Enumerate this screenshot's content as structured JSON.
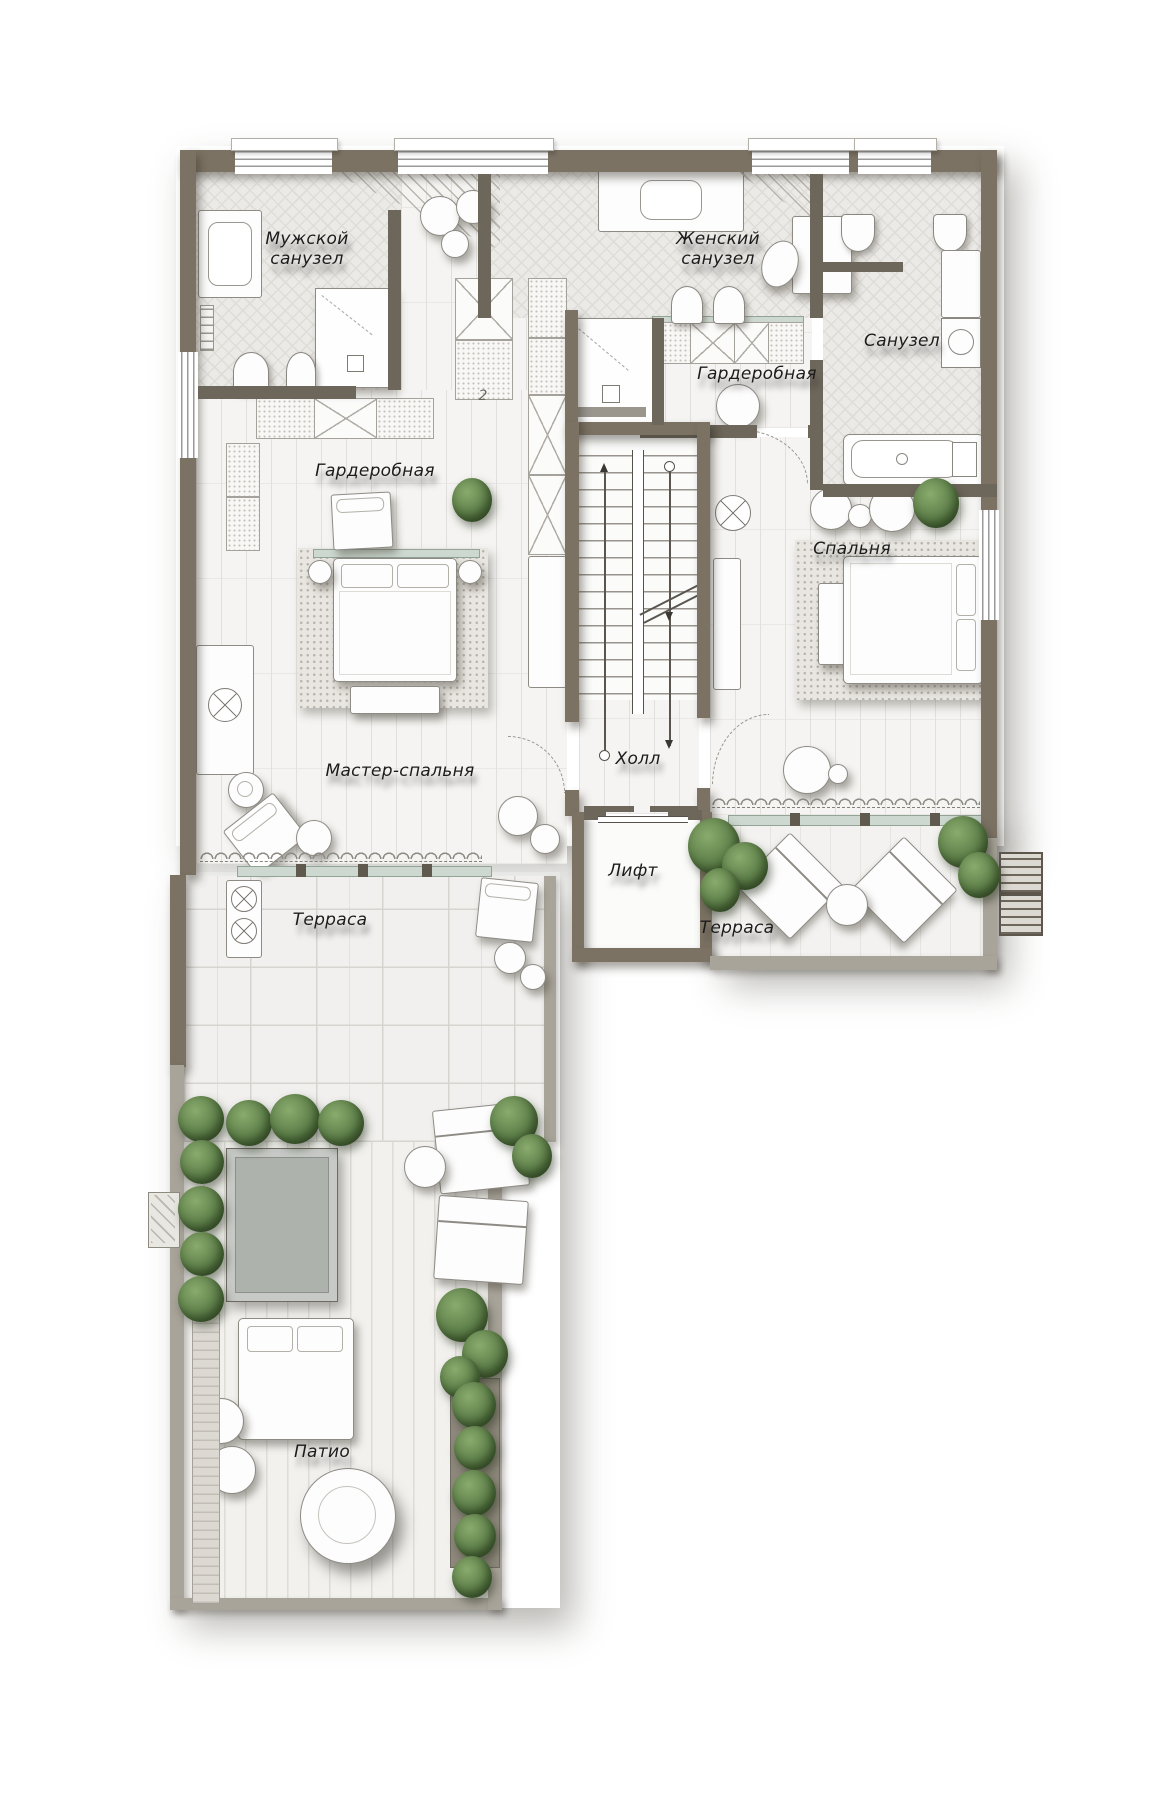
{
  "plan": {
    "rooms": [
      {
        "id": "mens-bathroom",
        "label": "Мужской\nсанузел"
      },
      {
        "id": "womens-bathroom",
        "label": "Женский\nсанузел"
      },
      {
        "id": "bathroom",
        "label": "Санузел"
      },
      {
        "id": "wardrobe-right",
        "label": "Гардеробная"
      },
      {
        "id": "wardrobe-left",
        "label": "Гардеробная"
      },
      {
        "id": "bedroom",
        "label": "Спальня"
      },
      {
        "id": "master-bedroom",
        "label": "Мастер-спальня"
      },
      {
        "id": "hall",
        "label": "Холл"
      },
      {
        "id": "elevator",
        "label": "Лифт"
      },
      {
        "id": "terrace-left",
        "label": "Терраса"
      },
      {
        "id": "terrace-right",
        "label": "Терраса"
      },
      {
        "id": "patio",
        "label": "Патио"
      }
    ],
    "annotations": {
      "floor_mark": "2"
    },
    "colors": {
      "wall": "#7b7263",
      "wall_light": "#a9a49a",
      "floor": "#f5f4f2",
      "tile": "#eceae7",
      "glass": "#cdd8d0",
      "plant": "#5d7f49",
      "pool": "#adb2ad",
      "text": "#1c1c1c"
    }
  }
}
